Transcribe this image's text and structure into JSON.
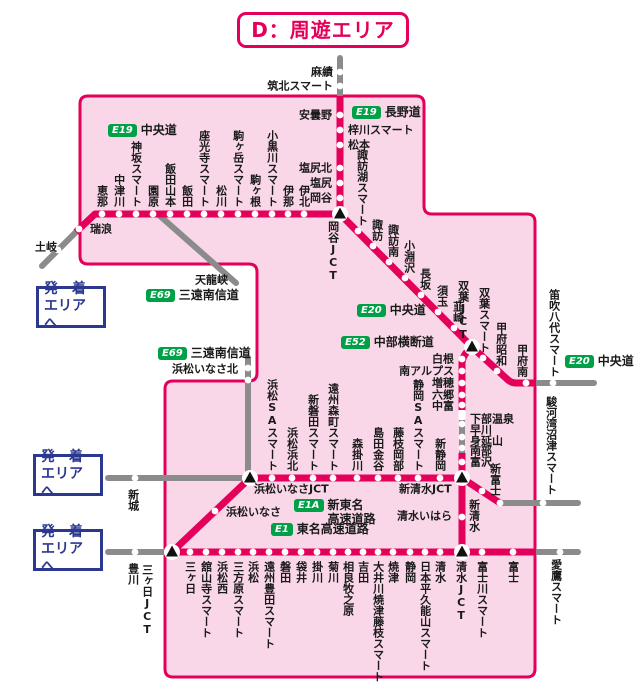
{
  "title": "D：周遊エリア",
  "colors": {
    "route_red": "#e4005a",
    "area_fill": "#f9d7e8",
    "grey": "#8b8b8b",
    "badge_green": "#00a046",
    "link_blue": "#2b3890",
    "text": "#1a1a1a"
  },
  "area_link_boxes": {
    "line1": "発　着",
    "line2": "エリアへ",
    "positions": [
      {
        "x": 36,
        "y": 286
      },
      {
        "x": 33,
        "y": 454
      },
      {
        "x": 33,
        "y": 529
      }
    ]
  },
  "badges": [
    {
      "badge": "E19",
      "name": "中央道",
      "x": 108,
      "y": 124
    },
    {
      "badge": "E19",
      "name": "長野道",
      "x": 352,
      "y": 106
    },
    {
      "badge": "E20",
      "name": "中央道",
      "x": 357,
      "y": 304
    },
    {
      "badge": "E52",
      "name": "中部横断道",
      "x": 341,
      "y": 336
    },
    {
      "badge": "E69",
      "name": "三遠南信道",
      "x": 146,
      "y": 289
    },
    {
      "badge": "E69",
      "name": "三遠南信道",
      "x": 158,
      "y": 347
    },
    {
      "badge": "E1A",
      "name": "新東名",
      "name2": "高速道路",
      "x": 294,
      "y": 499
    },
    {
      "badge": "E1",
      "name": "東名高速道路",
      "x": 271,
      "y": 523
    },
    {
      "badge": "E20",
      "name": "中央道",
      "x": 565,
      "y": 355
    }
  ],
  "map": {
    "area_path": "M 88,96 H 416 Q 424,96 424,104 V 206 Q 424,214 432,214 H 527 Q 535,214 535,222 V 669 Q 535,677 527,677 H 173 Q 165,677 165,669 V 389 Q 165,381 173,381 H 249 Q 257,381 257,373 V 272 Q 257,264 249,264 H 88 Q 80,264 80,256 V 104 Q 80,96 88,96 Z",
    "grey_paths": [
      "M 76,232 L 42,266",
      "M 340,96 V 58",
      "M 160,216 L 236,283",
      "M 248,358 V 478",
      "M 108,478 H 250",
      "M 108,552 H 172",
      "M 535,383 H 594",
      "M 500,503 H 578",
      "M 535,552 H 578",
      "M 462,408 V 455"
    ],
    "red_paths": [
      "M 76,232 L 95,214 H 341",
      "M 340,218 V 96",
      "M 340,214 L 472,347",
      "M 472,347 L 507,379 Q 511,383 516,383 H 536",
      "M 472,347 Q 462,355 462,364 V 410",
      "M 462,453 V 478",
      "M 250,478 H 462",
      "M 462,478 L 500,503",
      "M 462,478 V 552",
      "M 172,552 H 536",
      "M 172,552 L 250,478"
    ],
    "dots": [
      [
        102,
        214
      ],
      [
        119,
        214
      ],
      [
        136,
        214
      ],
      [
        153,
        214
      ],
      [
        170,
        214
      ],
      [
        187,
        214
      ],
      [
        204,
        214
      ],
      [
        221,
        214
      ],
      [
        238,
        214
      ],
      [
        255,
        214
      ],
      [
        272,
        214
      ],
      [
        288,
        214
      ],
      [
        304,
        214
      ],
      [
        79,
        229
      ],
      [
        58,
        250
      ],
      [
        340,
        115
      ],
      [
        340,
        130
      ],
      [
        340,
        145
      ],
      [
        340,
        168
      ],
      [
        340,
        183
      ],
      [
        340,
        198
      ],
      [
        340,
        72
      ],
      [
        340,
        86
      ],
      [
        358,
        231
      ],
      [
        373,
        246
      ],
      [
        389,
        262
      ],
      [
        405,
        278
      ],
      [
        421,
        295
      ],
      [
        438,
        312
      ],
      [
        454,
        328
      ],
      [
        483,
        358
      ],
      [
        497,
        371
      ],
      [
        526,
        383
      ],
      [
        553,
        383
      ],
      [
        462,
        359
      ],
      [
        462,
        371
      ],
      [
        462,
        383
      ],
      [
        462,
        395
      ],
      [
        462,
        405
      ],
      [
        462,
        424
      ],
      [
        462,
        437
      ],
      [
        462,
        448
      ],
      [
        462,
        462
      ],
      [
        272,
        478
      ],
      [
        292,
        478
      ],
      [
        313,
        478
      ],
      [
        333,
        478
      ],
      [
        357,
        478
      ],
      [
        378,
        478
      ],
      [
        398,
        478
      ],
      [
        418,
        478
      ],
      [
        440,
        478
      ],
      [
        135,
        478
      ],
      [
        482,
        491
      ],
      [
        500,
        503
      ],
      [
        543,
        503
      ],
      [
        462,
        517
      ],
      [
        190,
        552
      ],
      [
        206,
        552
      ],
      [
        222,
        552
      ],
      [
        238,
        552
      ],
      [
        253,
        552
      ],
      [
        269,
        552
      ],
      [
        285,
        552
      ],
      [
        301,
        552
      ],
      [
        317,
        552
      ],
      [
        333,
        552
      ],
      [
        348,
        552
      ],
      [
        363,
        552
      ],
      [
        378,
        552
      ],
      [
        393,
        552
      ],
      [
        410,
        552
      ],
      [
        425,
        552
      ],
      [
        440,
        552
      ],
      [
        482,
        552
      ],
      [
        513,
        552
      ],
      [
        135,
        552
      ],
      [
        560,
        552
      ],
      [
        215,
        511
      ],
      [
        248,
        368
      ],
      [
        248,
        380
      ]
    ],
    "squares": [
      [
        462,
        415
      ]
    ],
    "jcts": [
      [
        340,
        214
      ],
      [
        472,
        347
      ],
      [
        250,
        478
      ],
      [
        462,
        478
      ],
      [
        172,
        552
      ],
      [
        462,
        552
      ]
    ],
    "labels": [
      {
        "t": "恵那",
        "x": 102,
        "y": 207,
        "m": "vu"
      },
      {
        "t": "中津川",
        "x": 119,
        "y": 207,
        "m": "vu"
      },
      {
        "t": "神坂スマート",
        "x": 136,
        "y": 207,
        "m": "vu"
      },
      {
        "t": "園原",
        "x": 153,
        "y": 207,
        "m": "vu"
      },
      {
        "t": "飯田山本",
        "x": 170,
        "y": 207,
        "m": "vu"
      },
      {
        "t": "飯田",
        "x": 187,
        "y": 207,
        "m": "vu"
      },
      {
        "t": "座光寺スマート",
        "x": 204,
        "y": 207,
        "m": "vu"
      },
      {
        "t": "松川",
        "x": 221,
        "y": 207,
        "m": "vu"
      },
      {
        "t": "駒ヶ岳スマート",
        "x": 238,
        "y": 207,
        "m": "vu"
      },
      {
        "t": "駒ヶ根",
        "x": 255,
        "y": 207,
        "m": "vu"
      },
      {
        "t": "小黒川スマート",
        "x": 272,
        "y": 207,
        "m": "vu"
      },
      {
        "t": "伊那",
        "x": 288,
        "y": 207,
        "m": "vu"
      },
      {
        "t": "伊北",
        "x": 304,
        "y": 207,
        "m": "vu"
      },
      {
        "t": "諏訪湖スマート",
        "x": 362,
        "y": 226,
        "m": "vu"
      },
      {
        "t": "諏訪",
        "x": 377,
        "y": 241,
        "m": "vu"
      },
      {
        "t": "諏訪南",
        "x": 393,
        "y": 257,
        "m": "vu"
      },
      {
        "t": "小淵沢",
        "x": 409,
        "y": 273,
        "m": "vu"
      },
      {
        "t": "長坂",
        "x": 425,
        "y": 290,
        "m": "vu"
      },
      {
        "t": "須玉",
        "x": 442,
        "y": 307,
        "m": "vu"
      },
      {
        "t": "韮崎",
        "x": 458,
        "y": 323,
        "m": "vu"
      },
      {
        "t": "双葉JCT",
        "x": 463,
        "y": 341,
        "m": "vu"
      },
      {
        "t": "双葉スマート",
        "x": 484,
        "y": 353,
        "m": "vu"
      },
      {
        "t": "甲府昭和",
        "x": 501,
        "y": 366,
        "m": "vu"
      },
      {
        "t": "甲府南",
        "x": 522,
        "y": 377,
        "m": "vu"
      },
      {
        "t": "笛吹八代スマート",
        "x": 554,
        "y": 377,
        "m": "vu"
      },
      {
        "t": "浜松SAスマート",
        "x": 272,
        "y": 471,
        "m": "vu"
      },
      {
        "t": "浜松浜北",
        "x": 292,
        "y": 471,
        "m": "vu"
      },
      {
        "t": "新磐田スマート",
        "x": 313,
        "y": 471,
        "m": "vu"
      },
      {
        "t": "遠州森町スマート",
        "x": 333,
        "y": 471,
        "m": "vu"
      },
      {
        "t": "森掛川",
        "x": 357,
        "y": 471,
        "m": "vu"
      },
      {
        "t": "島田金谷",
        "x": 378,
        "y": 471,
        "m": "vu"
      },
      {
        "t": "藤枝岡部",
        "x": 398,
        "y": 471,
        "m": "vu"
      },
      {
        "t": "静岡SAスマート",
        "x": 418,
        "y": 471,
        "m": "vu"
      },
      {
        "t": "新静岡",
        "x": 440,
        "y": 471,
        "m": "vu"
      },
      {
        "t": "新富士",
        "x": 495,
        "y": 496,
        "m": "vu"
      },
      {
        "t": "岡谷JCT",
        "x": 333,
        "y": 221,
        "m": "vd"
      },
      {
        "t": "新城",
        "x": 133,
        "y": 489,
        "m": "vd"
      },
      {
        "t": "豊川",
        "x": 133,
        "y": 563,
        "m": "vd"
      },
      {
        "t": "三ヶ日JCT",
        "x": 147,
        "y": 564,
        "m": "vd"
      },
      {
        "t": "三ヶ日",
        "x": 190,
        "y": 561,
        "m": "vd"
      },
      {
        "t": "舘山寺スマート",
        "x": 206,
        "y": 561,
        "m": "vd"
      },
      {
        "t": "浜松西",
        "x": 222,
        "y": 561,
        "m": "vd"
      },
      {
        "t": "三方原スマート",
        "x": 238,
        "y": 561,
        "m": "vd"
      },
      {
        "t": "浜松",
        "x": 253,
        "y": 561,
        "m": "vd"
      },
      {
        "t": "遠州豊田スマート",
        "x": 269,
        "y": 561,
        "m": "vd"
      },
      {
        "t": "磐田",
        "x": 285,
        "y": 561,
        "m": "vd"
      },
      {
        "t": "袋井",
        "x": 301,
        "y": 561,
        "m": "vd"
      },
      {
        "t": "掛川",
        "x": 317,
        "y": 561,
        "m": "vd"
      },
      {
        "t": "菊川",
        "x": 333,
        "y": 561,
        "m": "vd"
      },
      {
        "t": "相良牧之原",
        "x": 348,
        "y": 561,
        "m": "vd"
      },
      {
        "t": "吉田",
        "x": 363,
        "y": 561,
        "m": "vd"
      },
      {
        "t": "大井川焼津藤枝スマート",
        "x": 378,
        "y": 561,
        "m": "vd"
      },
      {
        "t": "焼津",
        "x": 393,
        "y": 561,
        "m": "vd"
      },
      {
        "t": "静岡",
        "x": 410,
        "y": 561,
        "m": "vd"
      },
      {
        "t": "日本平久能山スマート",
        "x": 425,
        "y": 561,
        "m": "vd"
      },
      {
        "t": "清水",
        "x": 440,
        "y": 561,
        "m": "vd"
      },
      {
        "t": "清水JCT",
        "x": 461,
        "y": 561,
        "m": "vd"
      },
      {
        "t": "富士川スマート",
        "x": 482,
        "y": 561,
        "m": "vd"
      },
      {
        "t": "富士",
        "x": 513,
        "y": 561,
        "m": "vd"
      },
      {
        "t": "愛鷹スマート",
        "x": 556,
        "y": 559,
        "m": "vd"
      },
      {
        "t": "駿河湾沼津スマート",
        "x": 551,
        "y": 396,
        "m": "vd"
      },
      {
        "t": "新清水",
        "x": 474,
        "y": 499,
        "m": "vd"
      },
      {
        "t": "麻績",
        "x": 333,
        "y": 72,
        "m": "hr"
      },
      {
        "t": "筑北スマート",
        "x": 333,
        "y": 86,
        "m": "hr"
      },
      {
        "t": "安曇野",
        "x": 332,
        "y": 115,
        "m": "hr"
      },
      {
        "t": "塩尻北",
        "x": 332,
        "y": 168,
        "m": "hr"
      },
      {
        "t": "塩尻",
        "x": 332,
        "y": 183,
        "m": "hr"
      },
      {
        "t": "岡谷",
        "x": 332,
        "y": 198,
        "m": "hr"
      },
      {
        "t": "白根",
        "x": 454,
        "y": 359,
        "m": "hr"
      },
      {
        "t": "南アルプス",
        "x": 454,
        "y": 371,
        "m": "hr"
      },
      {
        "t": "増穂",
        "x": 454,
        "y": 383,
        "m": "hr"
      },
      {
        "t": "六郷",
        "x": 454,
        "y": 395,
        "m": "hr"
      },
      {
        "t": "中富",
        "x": 454,
        "y": 406,
        "m": "hr"
      },
      {
        "t": "清水いはら",
        "x": 452,
        "y": 516,
        "m": "hr"
      },
      {
        "t": "土岐",
        "x": 57,
        "y": 247,
        "m": "hr"
      },
      {
        "t": "梓川スマート",
        "x": 348,
        "y": 130,
        "m": "hl"
      },
      {
        "t": "松本",
        "x": 348,
        "y": 145,
        "m": "hl"
      },
      {
        "t": "下部温泉",
        "x": 470,
        "y": 419,
        "m": "hl"
      },
      {
        "t": "早川",
        "x": 470,
        "y": 430,
        "m": "hl"
      },
      {
        "t": "身延山",
        "x": 470,
        "y": 441,
        "m": "hl"
      },
      {
        "t": "南部",
        "x": 470,
        "y": 451,
        "m": "hl"
      },
      {
        "t": "富沢",
        "x": 470,
        "y": 462,
        "m": "hl"
      },
      {
        "t": "瑞浪",
        "x": 90,
        "y": 229,
        "m": "hl"
      },
      {
        "t": "天龍峡",
        "x": 195,
        "y": 280,
        "m": "hl"
      },
      {
        "t": "浜松いなさJCT",
        "x": 254,
        "y": 489,
        "m": "hl"
      },
      {
        "t": "浜松いなさ",
        "x": 226,
        "y": 512,
        "m": "hl"
      },
      {
        "t": "新清水JCT",
        "x": 399,
        "y": 489,
        "m": "hl"
      },
      {
        "t": "浜松いなさ北",
        "x": 172,
        "y": 369,
        "m": "hl"
      }
    ]
  }
}
